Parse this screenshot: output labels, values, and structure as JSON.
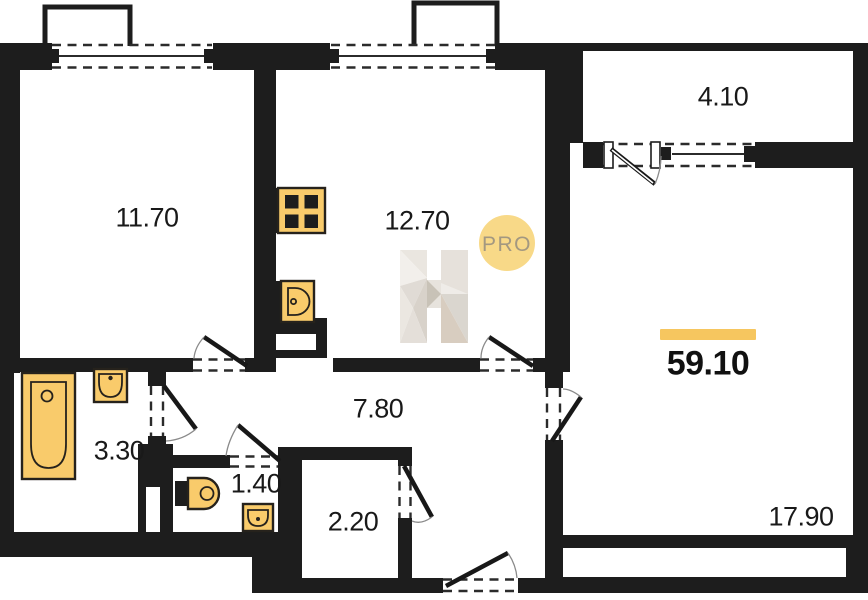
{
  "floorplan": {
    "total_area": "59.10",
    "rooms": [
      {
        "name": "bedroom",
        "area": "11.70"
      },
      {
        "name": "kitchen",
        "area": "12.70"
      },
      {
        "name": "balcony",
        "area": "4.10"
      },
      {
        "name": "living-room",
        "area": "17.90"
      },
      {
        "name": "bathroom",
        "area": "3.30"
      },
      {
        "name": "hallway",
        "area": "7.80"
      },
      {
        "name": "wc",
        "area": "1.40"
      },
      {
        "name": "storage",
        "area": "2.20"
      }
    ],
    "watermark": {
      "badge": "PRO"
    },
    "colors": {
      "wall": "#1d1d1d",
      "fixture": "#F9CB6B",
      "accent_bar": "#F6C65F",
      "badge_bg": "#F7D67E",
      "badge_text": "#A39880",
      "watermark_gray": "#DCD6CE"
    }
  }
}
